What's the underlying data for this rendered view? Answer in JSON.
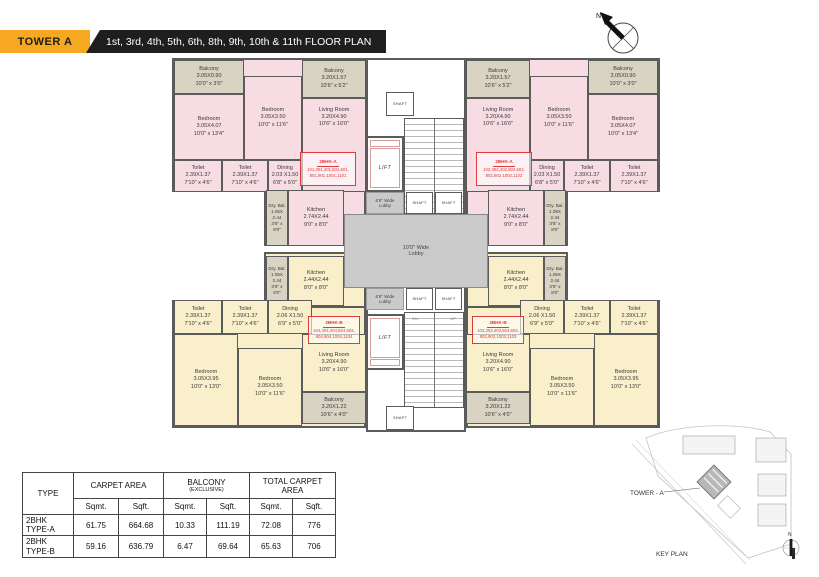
{
  "header": {
    "tower": "TOWER A",
    "title": "1st, 3rd, 4th, 5th, 6th, 8th, 9th, 10th & 11th FLOOR PLAN"
  },
  "north": {
    "n": "N"
  },
  "core": {
    "lift": "LIFT",
    "shaft": "SHAFT",
    "lobby_center_1": "10'0\" Wide",
    "lobby_center_2": "Lobby",
    "lobby_side_1": "6'6\" Wide",
    "lobby_side_2": "Lobby",
    "up": "UP",
    "dn": "DN"
  },
  "rooms_a": {
    "balcony_small": {
      "name": "Balcony",
      "m": "3.05X0.90",
      "ft": "10'0\" x 3'0\""
    },
    "bedroom_large": {
      "name": "Bedroom",
      "m": "3.05X4.07",
      "ft": "10'0\" x 13'4\""
    },
    "bedroom_mid": {
      "name": "Bedroom",
      "m": "3.05X3.50",
      "ft": "10'0\" x 11'6\""
    },
    "balcony_living": {
      "name": "Balcony",
      "m": "3.20X1.57",
      "ft": "10'6\" x 5'2\""
    },
    "living": {
      "name": "Living Room",
      "m": "3.20X4.90",
      "ft": "10'6\" x 16'0\""
    },
    "toilet": {
      "name": "Toilet",
      "m": "2.39X1.37",
      "ft": "7'10\" x 4'6\""
    },
    "dining": {
      "name": "Dining",
      "m": "2.03 X1.50",
      "ft": "6'8\" x 5'0\""
    },
    "dry_bal": {
      "name": "Dry. Bal.",
      "m": "1.05X 2.44",
      "ft": "3'6\" x 8'0\""
    },
    "kitchen": {
      "name": "Kitchen",
      "m": "2.74X2.44",
      "ft": "9'0\" x 8'0\""
    }
  },
  "rooms_b": {
    "dry_bal": {
      "name": "Dry. Bal.",
      "m": "1.05X 2.44",
      "ft": "3'6\" x 8'0\""
    },
    "kitchen": {
      "name": "Kitchen",
      "m": "2.44X2.44",
      "ft": "8'0\" x 8'0\""
    },
    "toilet": {
      "name": "Toilet",
      "m": "2.39X1.37",
      "ft": "7'10\" x 4'6\""
    },
    "dining": {
      "name": "Dining",
      "m": "2.06 X1.50",
      "ft": "6'9\" x 5'0\""
    },
    "living": {
      "name": "Living Room",
      "m": "3.20X4.90",
      "ft": "10'6\" x 16'0\""
    },
    "bedroom_large": {
      "name": "Bedroom",
      "m": "3.05X3.95",
      "ft": "10'0\" x 13'0\""
    },
    "bedroom_mid": {
      "name": "Bedroom",
      "m": "3.05X3.50",
      "ft": "10'0\" x 11'6\""
    },
    "balcony": {
      "name": "Balcony",
      "m": "3.20X1.22",
      "ft": "10'6\" x 4'0\""
    }
  },
  "flats": {
    "tl": {
      "type": "2BHK-A",
      "nums1": "101,301,401,501,601,",
      "nums2": "801,901,1001,1101"
    },
    "tr": {
      "type": "2BHK-A",
      "nums1": "102,302,402,502,602,",
      "nums2": "802,902,1002,1102"
    },
    "bl": {
      "type": "2BHK-B",
      "nums1": "104,304,404,504,604,",
      "nums2": "804,904,1004,1104"
    },
    "br": {
      "type": "2BHK-B",
      "nums1": "103,303,403,503,603,",
      "nums2": "803,903,1003,1103"
    }
  },
  "table": {
    "col_type": "TYPE",
    "col_carpet": "CARPET AREA",
    "col_balcony": "BALCONY",
    "col_balcony_sub": "(EXCLUSIVE)",
    "col_total": "TOTAL CARPET AREA",
    "sqmt": "Sqmt.",
    "sqft": "Sqft.",
    "rows": [
      {
        "type1": "2BHK",
        "type2": "TYPE-A",
        "c_sqmt": "61.75",
        "c_sqft": "664.68",
        "b_sqmt": "10.33",
        "b_sqft": "111.19",
        "t_sqmt": "72.08",
        "t_sqft": "776"
      },
      {
        "type1": "2BHK",
        "type2": "TYPE-B",
        "c_sqmt": "59.16",
        "c_sqft": "636.79",
        "b_sqmt": "6.47",
        "b_sqft": "69.64",
        "t_sqmt": "65.63",
        "t_sqft": "706"
      }
    ]
  },
  "key_plan": {
    "tower_label": "TOWER - A",
    "caption": "KEY PLAN"
  },
  "colors": {
    "accent_orange": "#F6A821",
    "banner_black": "#1E1E1E",
    "unit_pink": "#F7DCE3",
    "unit_cream": "#F9EFCB",
    "balcony_gray": "#D8D3C3",
    "lobby_gray": "#CACACA",
    "wall_gray": "#5B5B5B",
    "flat_red": "#E23A3A"
  }
}
